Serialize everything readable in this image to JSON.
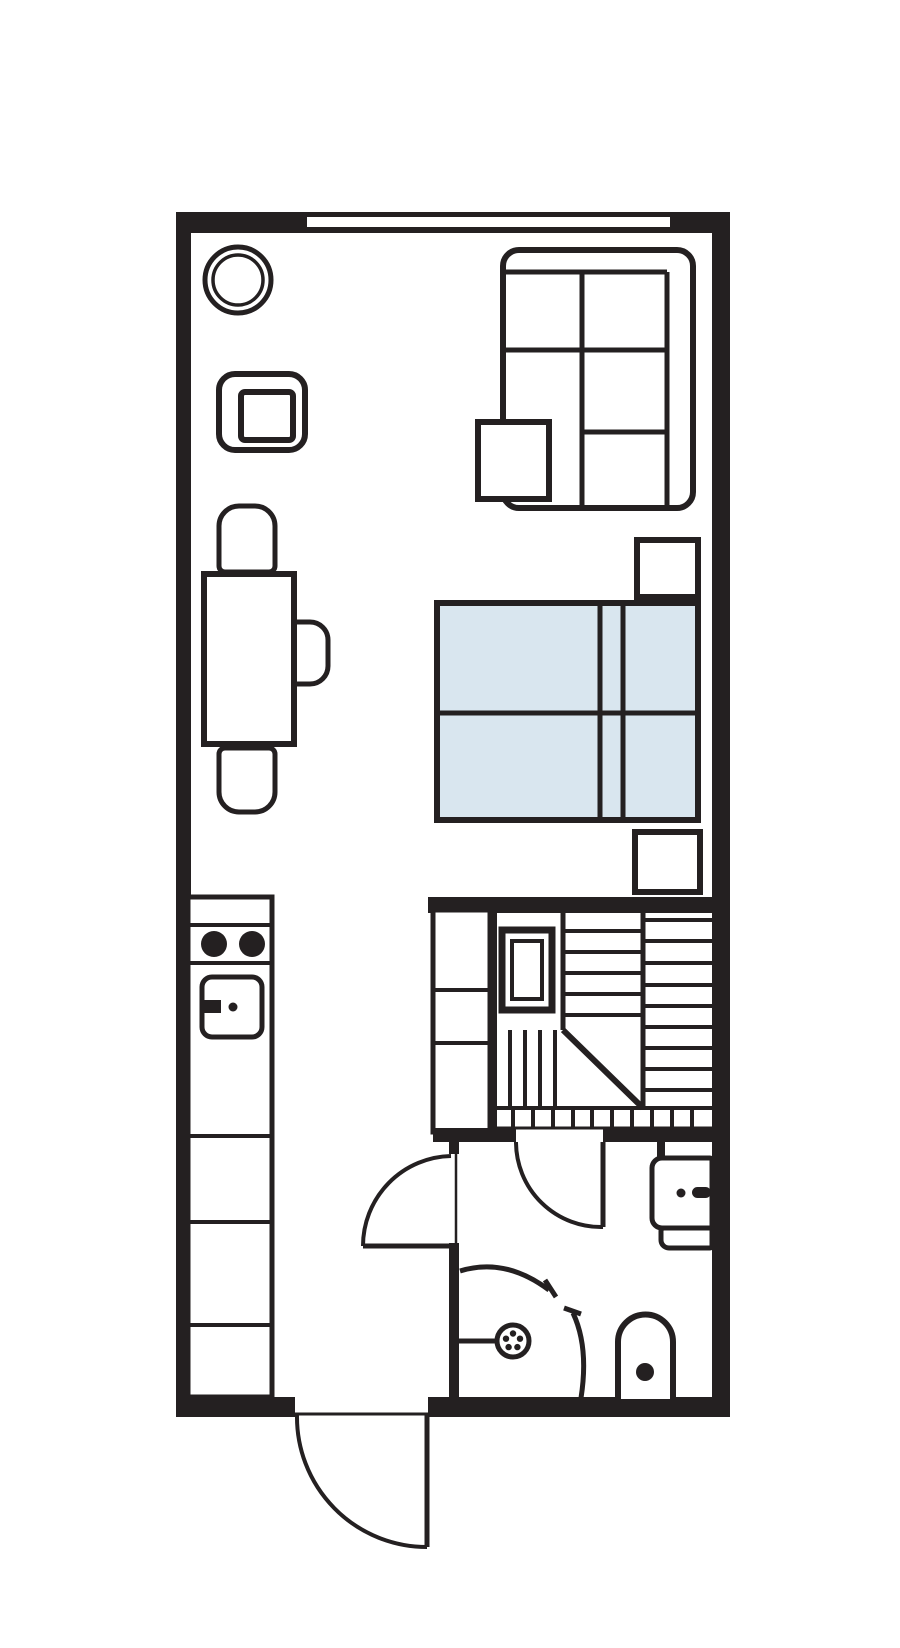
{
  "meta": {
    "title": "studio-apartment-floor-plan",
    "canvas": {
      "w": 900,
      "h": 1648
    },
    "colors": {
      "ink": "#242021",
      "bg": "#ffffff",
      "bed": "#d9e6ef",
      "none": "none"
    }
  },
  "elements": [
    {
      "name": "wall-top",
      "type": "rect",
      "x": 176,
      "y": 212,
      "w": 554,
      "h": 21,
      "fill": "ink",
      "sw": 0
    },
    {
      "name": "window-top",
      "type": "rect",
      "x": 307,
      "y": 217,
      "w": 363,
      "h": 10,
      "fill": "bg",
      "sw": 0
    },
    {
      "name": "wall-left",
      "type": "rect",
      "x": 176,
      "y": 212,
      "w": 15,
      "h": 1205,
      "fill": "ink",
      "sw": 0
    },
    {
      "name": "wall-right",
      "type": "rect",
      "x": 712,
      "y": 212,
      "w": 18,
      "h": 1205,
      "fill": "ink",
      "sw": 0
    },
    {
      "name": "wall-bottom-left",
      "type": "rect",
      "x": 176,
      "y": 1397,
      "w": 119,
      "h": 20,
      "fill": "ink",
      "sw": 0
    },
    {
      "name": "wall-bottom-right",
      "type": "rect",
      "x": 428,
      "y": 1397,
      "w": 302,
      "h": 20,
      "fill": "ink",
      "sw": 0
    },
    {
      "name": "wall-stairs-top",
      "type": "rect",
      "x": 428,
      "y": 897,
      "w": 284,
      "h": 16,
      "fill": "ink",
      "sw": 0
    },
    {
      "name": "closet",
      "type": "rect",
      "x": 433,
      "y": 910,
      "w": 57,
      "h": 222,
      "sw": 5,
      "fill": "bg"
    },
    {
      "name": "closet-shelf-line-1",
      "type": "line",
      "x1": 433,
      "y1": 990,
      "x2": 490,
      "y2": 990,
      "sw": 4
    },
    {
      "name": "closet-shelf-line-2",
      "type": "line",
      "x1": 433,
      "y1": 1043,
      "x2": 490,
      "y2": 1043,
      "sw": 4
    },
    {
      "name": "wall-closet-right",
      "type": "rect",
      "x": 488,
      "y": 903,
      "w": 9,
      "h": 229,
      "fill": "ink",
      "sw": 0
    },
    {
      "name": "wall-stairs-bottom-left",
      "type": "rect",
      "x": 433,
      "y": 1128,
      "w": 83,
      "h": 14,
      "fill": "ink",
      "sw": 0
    },
    {
      "name": "wall-stairs-bottom-right",
      "type": "rect",
      "x": 603,
      "y": 1128,
      "w": 109,
      "h": 14,
      "fill": "ink",
      "sw": 0
    },
    {
      "name": "wall-basin-stub",
      "type": "rect",
      "x": 657,
      "y": 1142,
      "w": 8,
      "h": 18,
      "fill": "ink",
      "sw": 0
    },
    {
      "name": "wall-hall-stub",
      "type": "rect",
      "x": 449,
      "y": 1140,
      "w": 10,
      "h": 14,
      "fill": "ink",
      "sw": 0
    },
    {
      "name": "wall-hall-lower",
      "type": "rect",
      "x": 449,
      "y": 1243,
      "w": 10,
      "h": 156,
      "fill": "ink",
      "sw": 0
    },
    {
      "name": "stairs-divider-left",
      "type": "line",
      "x1": 563,
      "y1": 913,
      "x2": 563,
      "y2": 1030,
      "sw": 5
    },
    {
      "name": "stairs-divider-right",
      "type": "line",
      "x1": 643,
      "y1": 913,
      "x2": 643,
      "y2": 1108,
      "sw": 5
    },
    {
      "name": "stairs-upper-treads",
      "type": "lines",
      "dir": "h",
      "x1": 563,
      "x2": 643,
      "ys": [
        931,
        952,
        973,
        994,
        1015
      ],
      "sw": 4
    },
    {
      "name": "stairs-right-treads",
      "type": "lines",
      "dir": "h",
      "x1": 643,
      "x2": 712,
      "ys": [
        920,
        941,
        963,
        985,
        1006,
        1027,
        1048,
        1069,
        1090
      ],
      "sw": 4
    },
    {
      "name": "stairs-winder-line",
      "type": "line",
      "x1": 563,
      "y1": 1030,
      "x2": 643,
      "y2": 1108,
      "sw": 6
    },
    {
      "name": "stairs-lower-treads",
      "type": "lines",
      "dir": "v",
      "y1": 1030,
      "y2": 1107,
      "xs": [
        510,
        525,
        540,
        555
      ],
      "sw": 4
    },
    {
      "name": "stairs-landing-top-line",
      "type": "line",
      "x1": 497,
      "y1": 1108,
      "x2": 712,
      "y2": 1108,
      "sw": 4
    },
    {
      "name": "stairs-landing-bottom-line",
      "type": "line",
      "x1": 497,
      "y1": 1128,
      "x2": 712,
      "y2": 1128,
      "sw": 3
    },
    {
      "name": "stairs-landing-ticks",
      "type": "lines",
      "dir": "v",
      "y1": 1108,
      "y2": 1128,
      "xs": [
        513,
        533,
        553,
        573,
        592,
        612,
        632,
        652,
        672,
        692
      ],
      "sw": 4
    },
    {
      "name": "sauna-window-outer",
      "type": "rect",
      "x": 502,
      "y": 930,
      "w": 50,
      "h": 80,
      "sw": 7,
      "fill": "bg"
    },
    {
      "name": "sauna-window-inner",
      "type": "rect",
      "x": 512,
      "y": 941,
      "w": 30,
      "h": 58,
      "sw": 4,
      "fill": "none"
    },
    {
      "name": "bathroom-door-leaf",
      "type": "line",
      "x1": 603,
      "y1": 1142,
      "x2": 603,
      "y2": 1227,
      "sw": 5
    },
    {
      "name": "bathroom-door-arc",
      "type": "path",
      "d": "M 516,1142 A 85,85 0 0 0 603,1227",
      "sw": 4
    },
    {
      "name": "hall-door-leaf",
      "type": "line",
      "x1": 363,
      "y1": 1246,
      "x2": 451,
      "y2": 1246,
      "sw": 5
    },
    {
      "name": "hall-door-arc",
      "type": "path",
      "d": "M 451,1156 A 90,90 0 0 0 363,1246",
      "sw": 4
    },
    {
      "name": "hall-door-frame",
      "type": "line",
      "x1": 456,
      "y1": 1154,
      "x2": 456,
      "y2": 1243,
      "sw": 2.5
    },
    {
      "name": "entry-threshold",
      "type": "line",
      "x1": 295,
      "y1": 1414,
      "x2": 428,
      "y2": 1414,
      "sw": 3
    },
    {
      "name": "entry-door-leaf",
      "type": "line",
      "x1": 427,
      "y1": 1415,
      "x2": 427,
      "y2": 1547,
      "sw": 5
    },
    {
      "name": "entry-door-arc",
      "type": "path",
      "d": "M 297,1415 A 130,130 0 0 0 427,1547",
      "sw": 4
    },
    {
      "name": "shower-arm",
      "type": "line",
      "x1": 459,
      "y1": 1341,
      "x2": 497,
      "y2": 1341,
      "sw": 5
    },
    {
      "name": "shower-head",
      "type": "circle",
      "cx": 513,
      "cy": 1341,
      "r": 16,
      "sw": 5,
      "fill": "bg"
    },
    {
      "name": "shower-head-holes",
      "type": "dots",
      "r": 3.2,
      "pts": [
        [
          513,
          1333.5
        ],
        [
          520,
          1338.7
        ],
        [
          517.4,
          1347.1
        ],
        [
          508.6,
          1347.1
        ],
        [
          506,
          1338.7
        ]
      ]
    },
    {
      "name": "shower-screen-arc-1",
      "type": "path",
      "d": "M 460,1271 Q 505,1257 549,1290",
      "sw": 5
    },
    {
      "name": "shower-screen-tick-1",
      "type": "line",
      "x1": 545,
      "y1": 1280,
      "x2": 556,
      "y2": 1297,
      "sw": 5
    },
    {
      "name": "shower-screen-arc-2",
      "type": "path",
      "d": "M 573,1313 Q 589,1347 581,1398",
      "sw": 5
    },
    {
      "name": "shower-screen-tick-2",
      "type": "line",
      "x1": 564,
      "y1": 1308,
      "x2": 581,
      "y2": 1314,
      "sw": 5
    },
    {
      "name": "toilet",
      "type": "path",
      "d": "M 618,1399 L 618,1342 A 27.5,27.5 0 0 1 673,1342 L 673,1399",
      "sw": 6,
      "fill": "bg"
    },
    {
      "name": "toilet-drain",
      "type": "circle",
      "cx": 645,
      "cy": 1372,
      "r": 9,
      "fill": "ink",
      "sw": 0
    },
    {
      "name": "basin",
      "type": "rrect",
      "x": 652,
      "y": 1158,
      "w": 60,
      "h": 70,
      "radii": [
        10,
        2,
        2,
        10
      ],
      "sw": 5,
      "fill": "bg"
    },
    {
      "name": "basin-shelf",
      "type": "rrect",
      "x": 661,
      "y": 1228,
      "w": 51,
      "h": 20,
      "radii": [
        3,
        2,
        2,
        8
      ],
      "sw": 5,
      "fill": "bg"
    },
    {
      "name": "basin-drain",
      "type": "circle",
      "cx": 681,
      "cy": 1193,
      "r": 4.5,
      "fill": "ink",
      "sw": 0
    },
    {
      "name": "basin-faucet",
      "type": "rrect",
      "x": 692,
      "y": 1187,
      "w": 19,
      "h": 11,
      "radii": [
        5.5,
        5.5,
        5.5,
        5.5
      ],
      "fill": "ink",
      "sw": 0
    },
    {
      "name": "round-table-outer",
      "type": "circle",
      "cx": 238,
      "cy": 280,
      "r": 33,
      "sw": 5,
      "fill": "bg"
    },
    {
      "name": "round-table-inner",
      "type": "circle",
      "cx": 238,
      "cy": 280,
      "r": 25,
      "sw": 3.5,
      "fill": "none"
    },
    {
      "name": "armchair-outer",
      "type": "rrect",
      "x": 219,
      "y": 374,
      "w": 86,
      "h": 76,
      "radii": [
        16,
        16,
        16,
        16
      ],
      "sw": 6,
      "fill": "bg",
      "rotate": [
        -22,
        262,
        412
      ]
    },
    {
      "name": "armchair-seat",
      "type": "rrect",
      "x": 241,
      "y": 392,
      "w": 52,
      "h": 48,
      "radii": [
        4,
        4,
        4,
        4
      ],
      "sw": 6,
      "fill": "none",
      "rotate": [
        -22,
        262,
        412
      ]
    },
    {
      "name": "dining-chair-top",
      "type": "rrect",
      "x": 219,
      "y": 506,
      "w": 56,
      "h": 66,
      "radii": [
        20,
        20,
        6,
        6
      ],
      "sw": 5,
      "fill": "bg"
    },
    {
      "name": "dining-chair-right",
      "type": "rrect",
      "x": 294,
      "y": 622,
      "w": 34,
      "h": 62,
      "radii": [
        2,
        18,
        18,
        2
      ],
      "sw": 5,
      "fill": "bg"
    },
    {
      "name": "dining-chair-bottom",
      "type": "rrect",
      "x": 219,
      "y": 748,
      "w": 56,
      "h": 64,
      "radii": [
        6,
        6,
        20,
        20
      ],
      "sw": 5,
      "fill": "bg"
    },
    {
      "name": "dining-table",
      "type": "rect",
      "x": 204,
      "y": 574,
      "w": 90,
      "h": 170,
      "sw": 6,
      "fill": "bg"
    },
    {
      "name": "sofa",
      "type": "rrect",
      "x": 503,
      "y": 250,
      "w": 190,
      "h": 258,
      "radii": [
        16,
        16,
        16,
        16
      ],
      "sw": 6,
      "fill": "bg"
    },
    {
      "name": "sofa-back-line",
      "type": "line",
      "x1": 506,
      "y1": 272,
      "x2": 667,
      "y2": 272,
      "sw": 5
    },
    {
      "name": "sofa-divider-vertical",
      "type": "line",
      "x1": 582,
      "y1": 272,
      "x2": 582,
      "y2": 505,
      "sw": 5
    },
    {
      "name": "sofa-right-back-line",
      "type": "line",
      "x1": 667,
      "y1": 272,
      "x2": 667,
      "y2": 505,
      "sw": 5
    },
    {
      "name": "sofa-seat-line-1",
      "type": "line",
      "x1": 506,
      "y1": 350,
      "x2": 667,
      "y2": 350,
      "sw": 5
    },
    {
      "name": "sofa-seat-line-2",
      "type": "line",
      "x1": 582,
      "y1": 432,
      "x2": 667,
      "y2": 432,
      "sw": 5
    },
    {
      "name": "coffee-table",
      "type": "rect",
      "x": 478,
      "y": 422,
      "w": 71,
      "h": 77,
      "sw": 6,
      "fill": "bg"
    },
    {
      "name": "nightstand-top",
      "type": "rect",
      "x": 637,
      "y": 540,
      "w": 61,
      "h": 57,
      "sw": 6,
      "fill": "bg"
    },
    {
      "name": "nightstand-bottom",
      "type": "rect",
      "x": 635,
      "y": 832,
      "w": 65,
      "h": 60,
      "sw": 6,
      "fill": "bg"
    },
    {
      "name": "bed",
      "type": "rect",
      "x": 437,
      "y": 603,
      "w": 261,
      "h": 217,
      "sw": 6,
      "fill": "bed"
    },
    {
      "name": "bed-divider-line-1",
      "type": "line",
      "x1": 600,
      "y1": 603,
      "x2": 600,
      "y2": 820,
      "sw": 5
    },
    {
      "name": "bed-divider-line-2",
      "type": "line",
      "x1": 623,
      "y1": 603,
      "x2": 623,
      "y2": 820,
      "sw": 5
    },
    {
      "name": "bed-blanket-line",
      "type": "line",
      "x1": 437,
      "y1": 713,
      "x2": 698,
      "y2": 713,
      "sw": 5
    },
    {
      "name": "kitchen-counter",
      "type": "rect",
      "x": 188,
      "y": 897,
      "w": 84,
      "h": 500,
      "sw": 5,
      "fill": "bg"
    },
    {
      "name": "kitchen-counter-dividers",
      "type": "lines",
      "dir": "h",
      "x1": 188,
      "x2": 272,
      "ys": [
        925,
        963,
        1136,
        1222,
        1325
      ],
      "sw": 4
    },
    {
      "name": "stove-burner-left",
      "type": "circle",
      "cx": 214,
      "cy": 944,
      "r": 13,
      "fill": "ink",
      "sw": 0
    },
    {
      "name": "stove-burner-right",
      "type": "circle",
      "cx": 252,
      "cy": 944,
      "r": 13,
      "fill": "ink",
      "sw": 0
    },
    {
      "name": "kitchen-sink",
      "type": "rrect",
      "x": 202,
      "y": 977,
      "w": 60,
      "h": 60,
      "radii": [
        10,
        10,
        10,
        10
      ],
      "sw": 5,
      "fill": "bg"
    },
    {
      "name": "sink-faucet",
      "type": "rect",
      "x": 203,
      "y": 1000,
      "w": 18,
      "h": 13,
      "fill": "ink",
      "sw": 0
    },
    {
      "name": "sink-drain",
      "type": "circle",
      "cx": 233,
      "cy": 1007,
      "r": 4.5,
      "fill": "ink",
      "sw": 0
    }
  ]
}
